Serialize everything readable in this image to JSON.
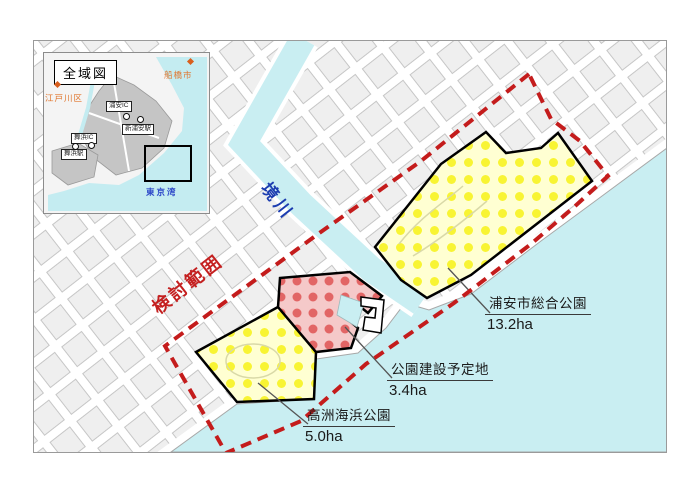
{
  "inset": {
    "title": "全域図",
    "bay_label": "東京湾",
    "cities": [
      {
        "label": "船橋市"
      },
      {
        "label": "江戸川区"
      }
    ],
    "stations": [
      {
        "label": "浦安IC"
      },
      {
        "label": "新浦安駅"
      },
      {
        "label": "舞浜IC"
      },
      {
        "label": "舞浜駅"
      }
    ]
  },
  "main": {
    "river_label": "境川",
    "boundary_label": "検討範囲",
    "sites": [
      {
        "name": "浦安市総合公園",
        "area": "13.2ha"
      },
      {
        "name": "公園建設予定地",
        "area": "3.4ha"
      },
      {
        "name": "高洲海浜公園",
        "area": "5.0ha"
      }
    ]
  },
  "colors": {
    "water": "#c9eef2",
    "park_yellow_bg": "#ffffd2",
    "park_yellow_dot": "#f7f32a",
    "site_red_bg": "#f5c9c9",
    "site_red_dot": "#e05a5a",
    "boundary_red": "#c41c1c"
  }
}
